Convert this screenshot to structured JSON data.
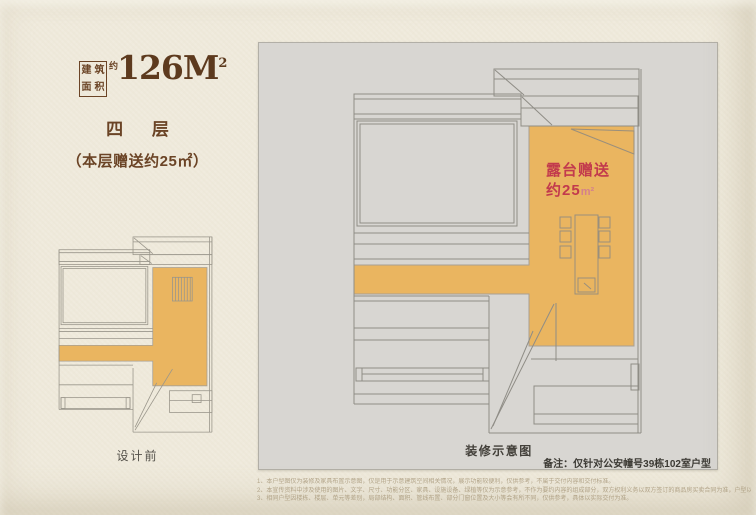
{
  "header": {
    "area_box_chars": [
      "建",
      "筑",
      "面",
      "积"
    ],
    "approx_label": "约",
    "area_value": "126M",
    "area_exponent": "2",
    "floor_title": "四 层",
    "floor_subtitle": "（本层赠送约25㎡）"
  },
  "before_plan": {
    "caption": "设计前"
  },
  "after_plan": {
    "caption": "装修示意图",
    "terrace_label": {
      "line1": "露台赠送",
      "line2_value": "约25",
      "line2_unit": "m²"
    },
    "note": "备注：仅针对公安幢号39栋102室户型"
  },
  "disclaimer": {
    "line1": "1、本户型图仅为装修及家具布置示意图，仅是用于示意建筑空间相关情况，展示功能较便利，仅供参考，不属于交付内容和交付标准。",
    "line2": "2、本宣传资料中涉及使用的图片、文字、尺寸、功能分区、家具、设施设备、绿植等仅为示意参考，不作为要约内容的组成部分，双方权利义务以双方签订的商品房买卖合同为准，户型以实际交付为准。",
    "line3": "3、相同户型因楼栋、楼层、单元等差别，局部结构、面积、管线布置、部分门窗位置及大小等会有所不同，仅供参考，具体以实际交付为准。"
  },
  "colors": {
    "paper": "#efeadc",
    "panel_gray": "#d8d6d2",
    "terrace_orange": "#eab560",
    "plan_line": "#8f8d86",
    "title_brown": "#6b4426",
    "accent_red": "#c23a4d"
  }
}
